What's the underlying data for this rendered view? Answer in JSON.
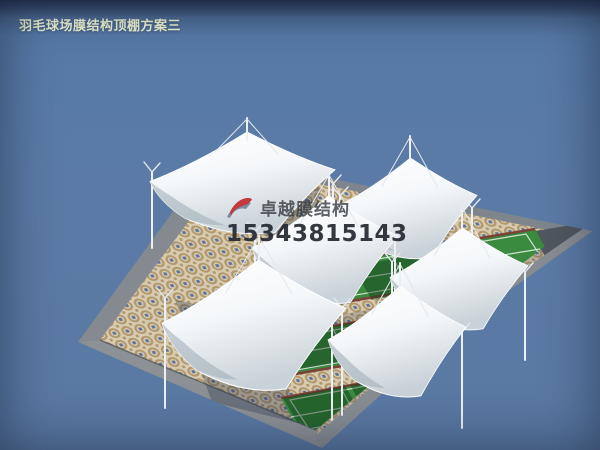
{
  "title": "羽毛球场膜结构顶棚方案三",
  "watermark": {
    "brand": "卓越膜结构",
    "phone": "15343815143"
  },
  "scene": {
    "description": "3D rendering of six white tensile membrane canopies (hypar sails on white masts with cable stays) covering three green badminton court strips laid on a mosaic-tiled plaza with gray concrete borders, viewed from above against a slate-blue sky",
    "canopy_count": 6,
    "court_strip_count": 3,
    "colors": {
      "sky": "#5878a4",
      "plaza_border": "#7e858c",
      "tile_base": "#d7ccb2",
      "tile_ring": "#b2976b",
      "tile_accent": "#61739a",
      "court_green": "#3a8a40",
      "court_green_light": "#4ba254",
      "court_trim": "#7b4238",
      "membrane": "#ffffff",
      "membrane_shade": "#c9d2d8",
      "logo_red": "#c1272d",
      "logo_blue": "#5d7494",
      "title_color": "#edf2d0"
    }
  }
}
